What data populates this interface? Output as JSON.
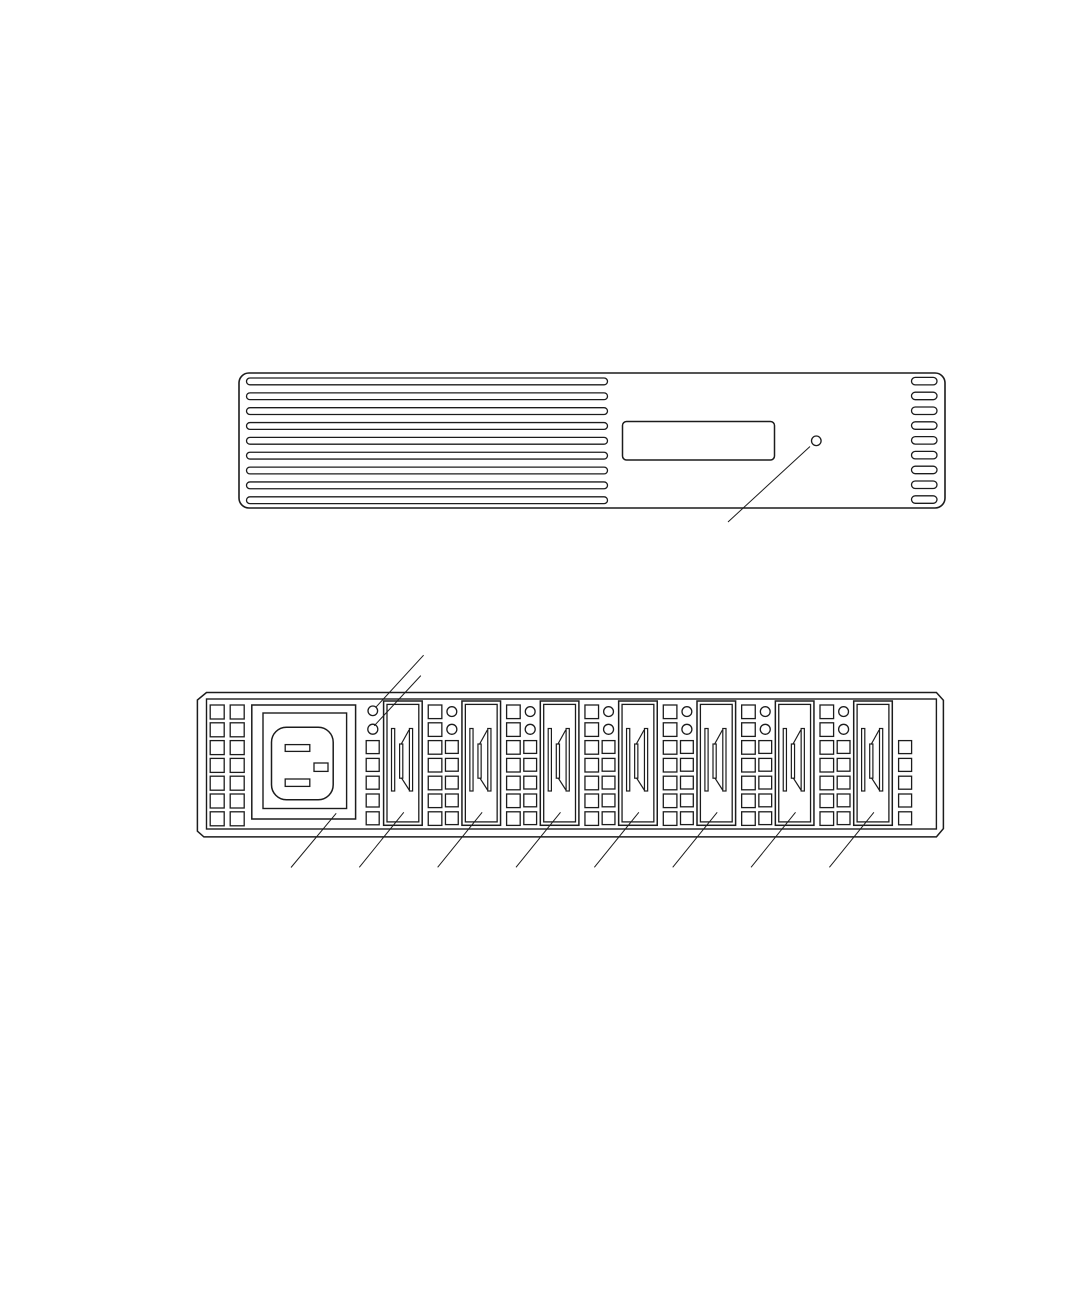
{
  "page": {
    "background_color": "#ffffff",
    "ink_color": "#1c1c1c",
    "width_px": 1080,
    "height_px": 1296,
    "description": "Black-and-white technical line illustration of a rack-mount device: front panel view (top) and rear panel view (bottom) with unlabeled callout leader lines"
  },
  "front_panel_figure": {
    "name": "front-panel-view",
    "left_vent_slots": 9,
    "right_vent_slots": 9,
    "label_plates": 1,
    "status_leds": 1,
    "leader_lines": 1
  },
  "rear_panel_figure": {
    "name": "rear-panel-view",
    "power_inlets": 1,
    "power_inlet_pins": 3,
    "module_slots": 7,
    "status_leds": 2,
    "left_vent_grid": {
      "columns": 2,
      "rows": 7
    },
    "between_module_vent_columns": 2,
    "leader_lines_top": 2,
    "leader_lines_bottom": 8
  }
}
